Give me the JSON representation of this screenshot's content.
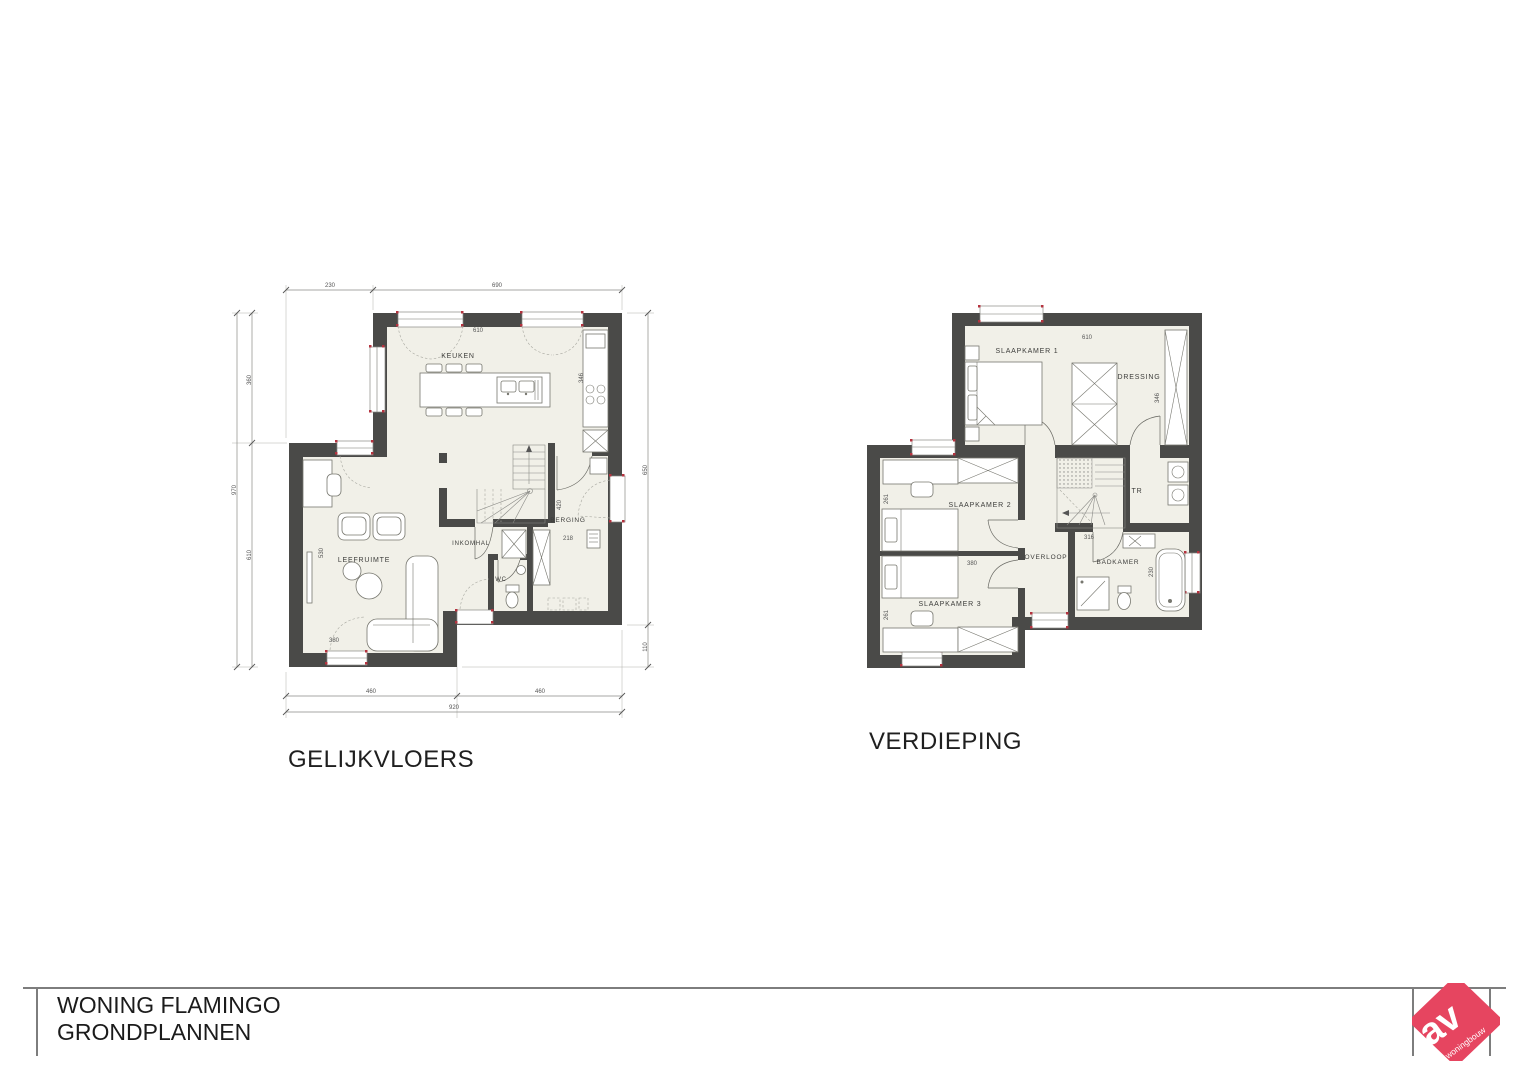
{
  "ground": {
    "title": "GELIJKVLOERS",
    "rooms": {
      "keuken": "KEUKEN",
      "leefruimte": "LEEFRUIMTE",
      "inkomhal": "INKOMHAL",
      "wc": "WC",
      "berging": "BERGING"
    },
    "dims": {
      "top_230": "230",
      "top_690": "690",
      "keuken_610": "610",
      "left_970": "970",
      "left_360": "360",
      "left_610": "610",
      "living_530": "530",
      "living_380": "380",
      "counter_346": "346",
      "stair_420": "420",
      "berging_218": "218",
      "right_650": "650",
      "right_110": "110",
      "bottom_460a": "460",
      "bottom_460b": "460",
      "bottom_920": "920"
    }
  },
  "upper": {
    "title": "VERDIEPING",
    "rooms": {
      "slaapkamer1": "SLAAPKAMER 1",
      "slaapkamer2": "SLAAPKAMER 2",
      "slaapkamer3": "SLAAPKAMER 3",
      "dressing": "DRESSING",
      "overloop": "OVERLOOP",
      "badkamer": "BADKAMER",
      "tr": "TR"
    },
    "dims": {
      "top_610": "610",
      "dressing_346": "346",
      "sk2_261": "261",
      "sk3_261": "261",
      "sk_380": "380",
      "overloop_316": "316",
      "badkamer_230": "230"
    }
  },
  "titleblock": {
    "project": "WONING FLAMINGO",
    "drawing": "GRONDPLANNEN"
  },
  "logo": {
    "initials": "av",
    "word": "woningbouw"
  },
  "colors": {
    "wall": "#4a4a48",
    "floor": "#f1f0e8",
    "logo_pink": "#e64560",
    "accent_red": "#b5333f"
  }
}
